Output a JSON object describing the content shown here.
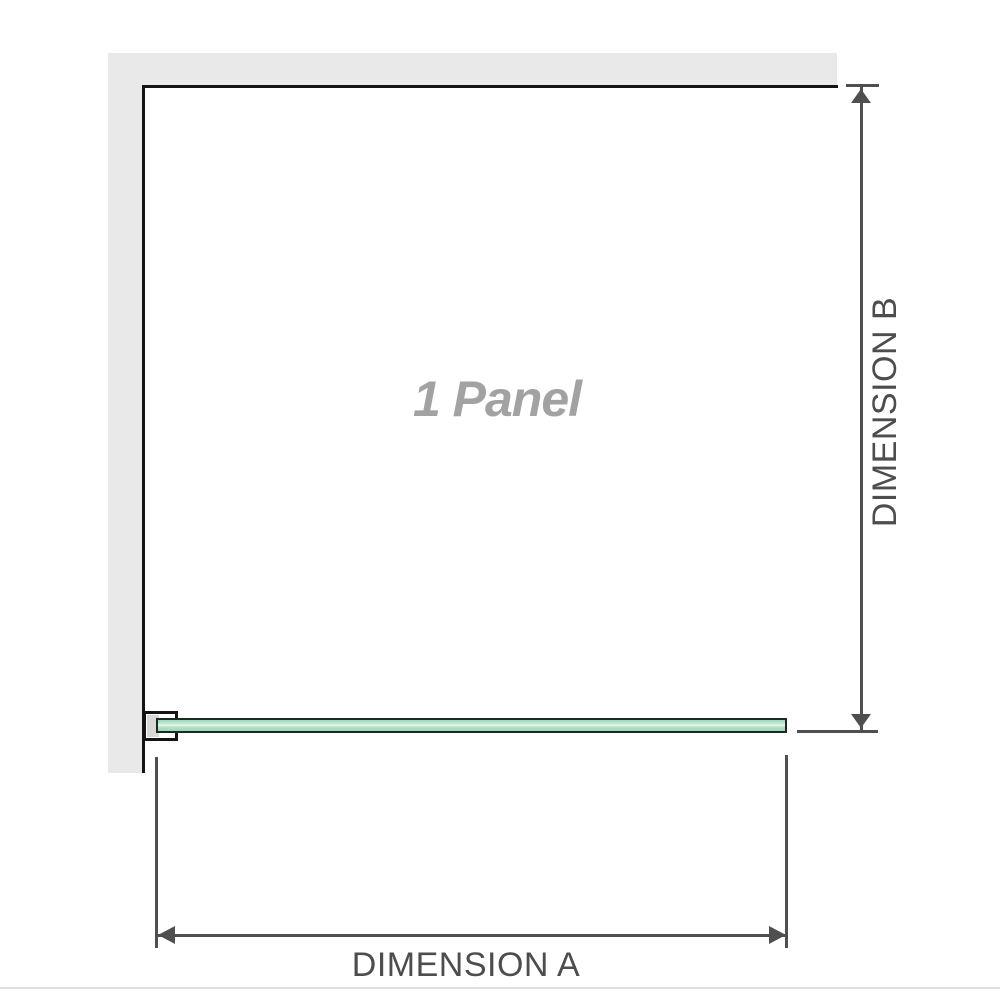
{
  "diagram": {
    "panel_label": "1 Panel",
    "dimension_a_label": "DIMENSION A",
    "dimension_b_label": "DIMENSION B"
  },
  "colors": {
    "wall": "#e9e9e9",
    "outline": "#141414",
    "dim": "#4f4f4f",
    "label": "#4d4d4d",
    "panel-text": "#a2a2a2",
    "glass-hi": "#e9f7ee",
    "glass-border": "#1d2a21",
    "bracket-fill": "#d8d8d8",
    "edge": "#e0dddd"
  }
}
